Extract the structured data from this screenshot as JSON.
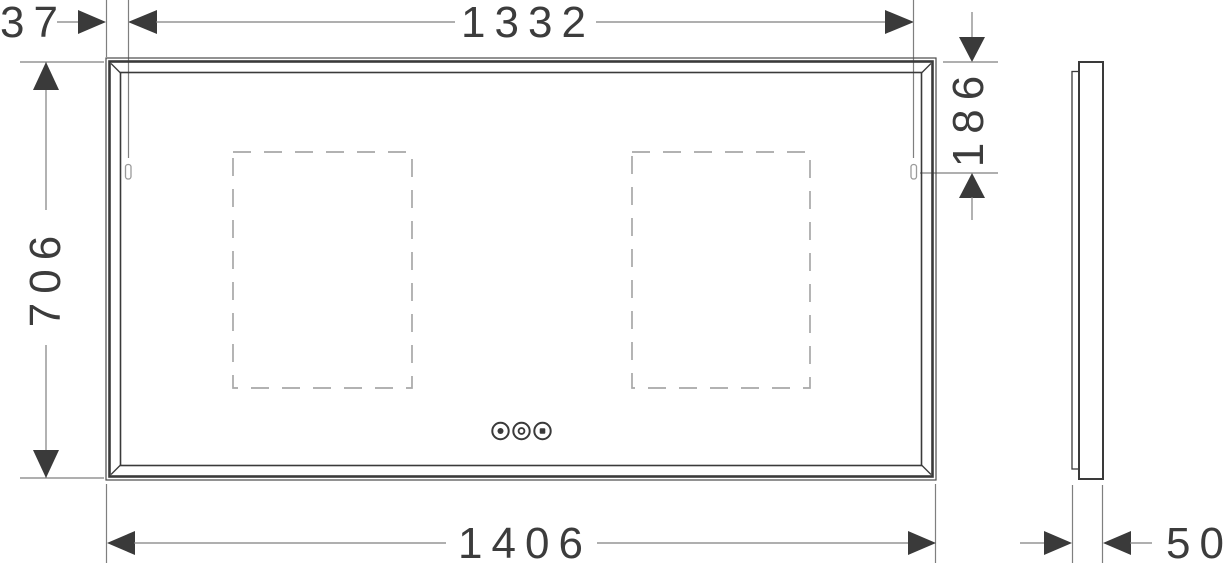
{
  "dimensions": {
    "hanger_offset": "37",
    "hanger_spacing": "1332",
    "hanger_drop": "186",
    "overall_height": "706",
    "overall_width": "1406",
    "depth": "50"
  },
  "colors": {
    "outline": "#3a3a3a",
    "dimension_line": "#7f7f7f",
    "dashed_zone": "#a8a8a8",
    "background": "#ffffff"
  }
}
